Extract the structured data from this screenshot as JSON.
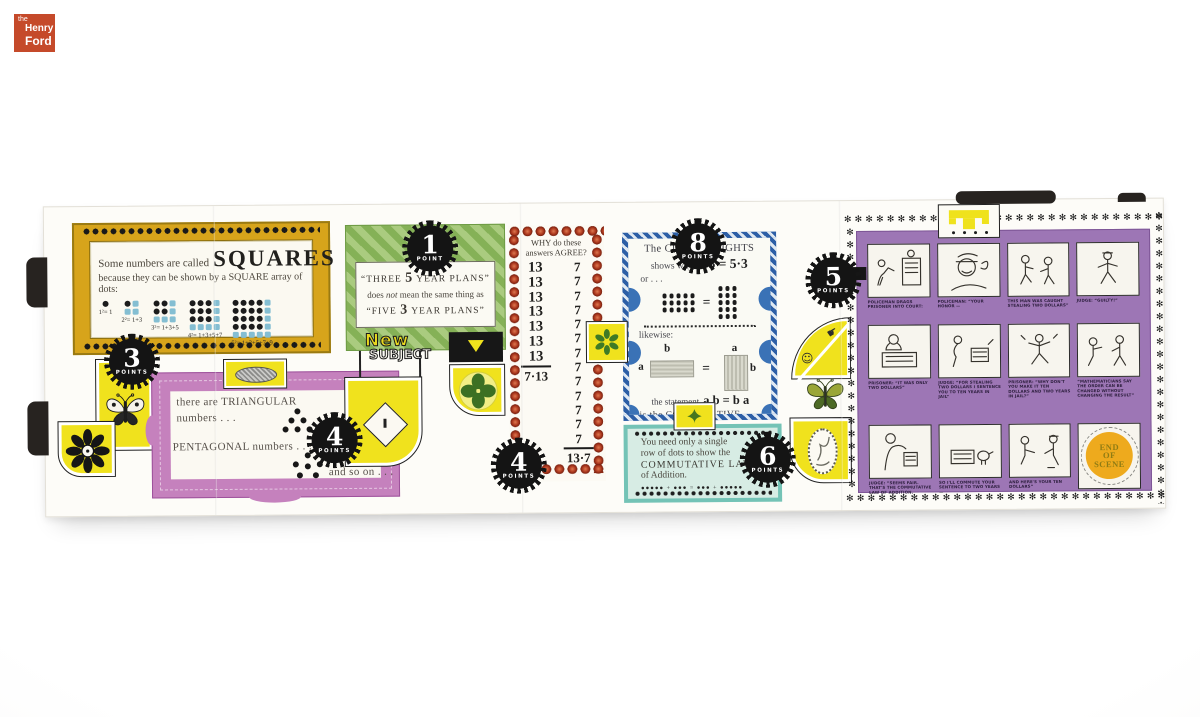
{
  "logo": {
    "the": "the",
    "henry": "Henry",
    "ford": "Ford"
  },
  "badges": {
    "squares": {
      "num": "3",
      "word": "POINTS"
    },
    "polygonal": {
      "num": "4",
      "word": "POINTS"
    },
    "plans": {
      "num": "1",
      "word": "POINT"
    },
    "agree": {
      "num": "4",
      "word": "POINTS"
    },
    "cube": {
      "num": "8",
      "word": "POINTS"
    },
    "addition": {
      "num": "6",
      "word": "POINTS"
    },
    "scene": {
      "num": "5",
      "word": "POINTS"
    }
  },
  "squares_panel": {
    "intro": "Some numbers are called",
    "title": "SQUARES",
    "subtitle": "because they can be shown by a SQUARE array of dots:",
    "equations": [
      "1²= 1",
      "2²= 1+3",
      "3²= 1+3+5",
      "4²= 1+3+5+7",
      "5²= 1+3+5+7+9"
    ]
  },
  "polygonal_panel": {
    "line1": "there are TRIANGULAR",
    "line2": "numbers . . .",
    "line3": "PENTAGONAL numbers . . .",
    "line4": "and so on . . ."
  },
  "plans_panel": {
    "quote1_pre": "“THREE",
    "quote1_num": "5",
    "quote1_post": "YEAR PLANS”",
    "mid_a": "does",
    "mid_b": "not",
    "mid_c": "mean the same thing as",
    "quote2_pre": "“FIVE",
    "quote2_num": "3",
    "quote2_post": "YEAR PLANS”"
  },
  "new_subject": {
    "word1": "New",
    "word2": "SUBJECT"
  },
  "agree_panel": {
    "header1": "WHY do these",
    "header2": "answers AGREE?",
    "left_addends": [
      "13",
      "13",
      "13",
      "13",
      "13",
      "13",
      "13"
    ],
    "left_product": "7·13",
    "right_addends": [
      "7",
      "7",
      "7",
      "7",
      "7",
      "7",
      "7",
      "7",
      "7",
      "7",
      "7",
      "7",
      "7"
    ],
    "right_product": "13·7"
  },
  "cube_panel": {
    "line1": "The CUBE OF LIGHTS",
    "line2_pre": "shows why",
    "line2_eq": "3·5 = 5·3",
    "line3": "or . . .",
    "eq_sign": "=",
    "likewise": "likewise:",
    "label_a": "a",
    "label_b": "b",
    "statement_pre": "the statement",
    "statement_eq": "a b = b a",
    "law1": "is the COMMUTATIVE LAW",
    "law2": "of Multiplication."
  },
  "addition_panel": {
    "line1": "You need only a single",
    "line2": "row of dots to show the",
    "line3": "COMMUTATIVE LAW",
    "line4": "of Addition.",
    "dots_equation": "●●●●●  +  ●●●  =  ●●●  +  ●●●●●"
  },
  "cartoon_panel": {
    "captions": [
      "POLICEMAN DRAGS PRISONER INTO COURT:",
      "POLICEMAN: “YOUR HONOR —",
      "THIS MAN WAS CAUGHT STEALING TWO DOLLARS”",
      "JUDGE: “GUILTY!”",
      "PRISONER: “IT WAS ONLY TWO DOLLARS”",
      "JUDGE: “FOR STEALING TWO DOLLARS I SENTENCE YOU TO TEN YEARS IN JAIL”",
      "PRISONER: “WHY DON'T YOU MAKE IT TEN DOLLARS AND TWO YEARS IN JAIL?”",
      "“MATHEMATICIANS SAY THE ORDER CAN BE CHANGED WITHOUT CHANGING THE RESULT”",
      "JUDGE: “SEEMS FAIR. THAT'S THE COMMUTATIVE LAW OF ADDITION.",
      "SO I'LL COMMUTE YOUR SENTENCE TO TWO YEARS —",
      "AND HERE'S YOUR TEN DOLLARS”"
    ],
    "end_circle": {
      "line1": "END",
      "line2": "OF",
      "line3": "SCENE"
    }
  },
  "decor": {
    "asterisk_row": "✻✻✻✻✻✻✻✻✻✻✻✻✻✻✻✻✻✻✻✻✻✻✻✻✻✻✻✻✻✻✻✻",
    "asterisk_col": "✻✻✻✻✻✻✻✻✻✻✻✻✻✻✻✻✻✻✻✻✻✻✻✻✻✻"
  }
}
